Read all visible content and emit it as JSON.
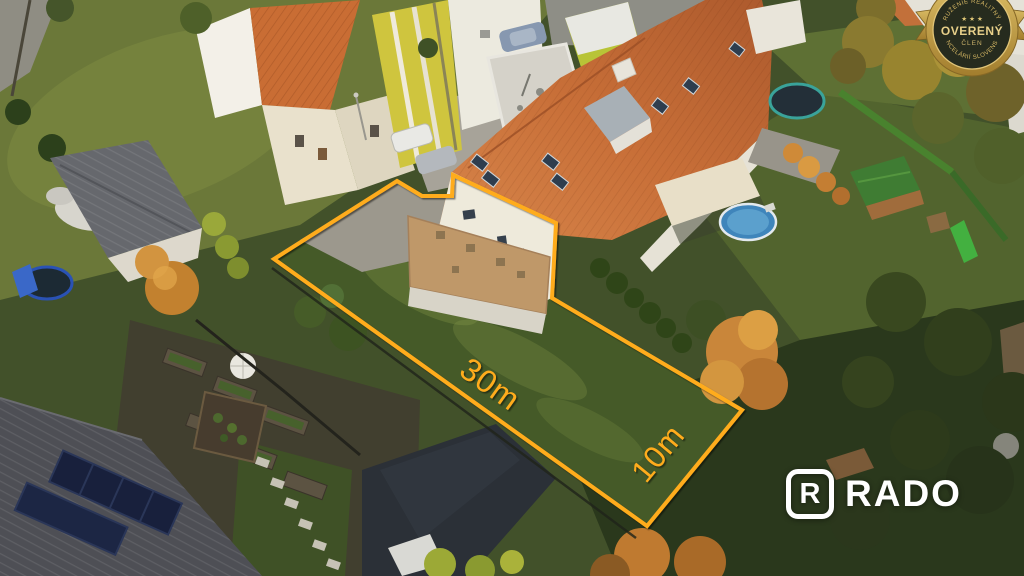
{
  "photo_overlay": {
    "outline_color": "#FFAC1E",
    "plot_polygon": "397,181 422,196 452,196 453,175 556,223 552,298 742,410 647,526 274,259",
    "measurement_long": "30m",
    "measurement_short": "10m"
  },
  "membership_badge": {
    "arc_top": "ZDRUŽENIE REALITNÝCH",
    "arc_bottom": "KANCELÁRIÍ SLOVENSKA",
    "stars": "★ ★ ★",
    "title": "OVERENÝ",
    "subtitle": "ČLEN"
  },
  "watermark_logo": {
    "brand": "RADO",
    "icon_letter": "R"
  }
}
